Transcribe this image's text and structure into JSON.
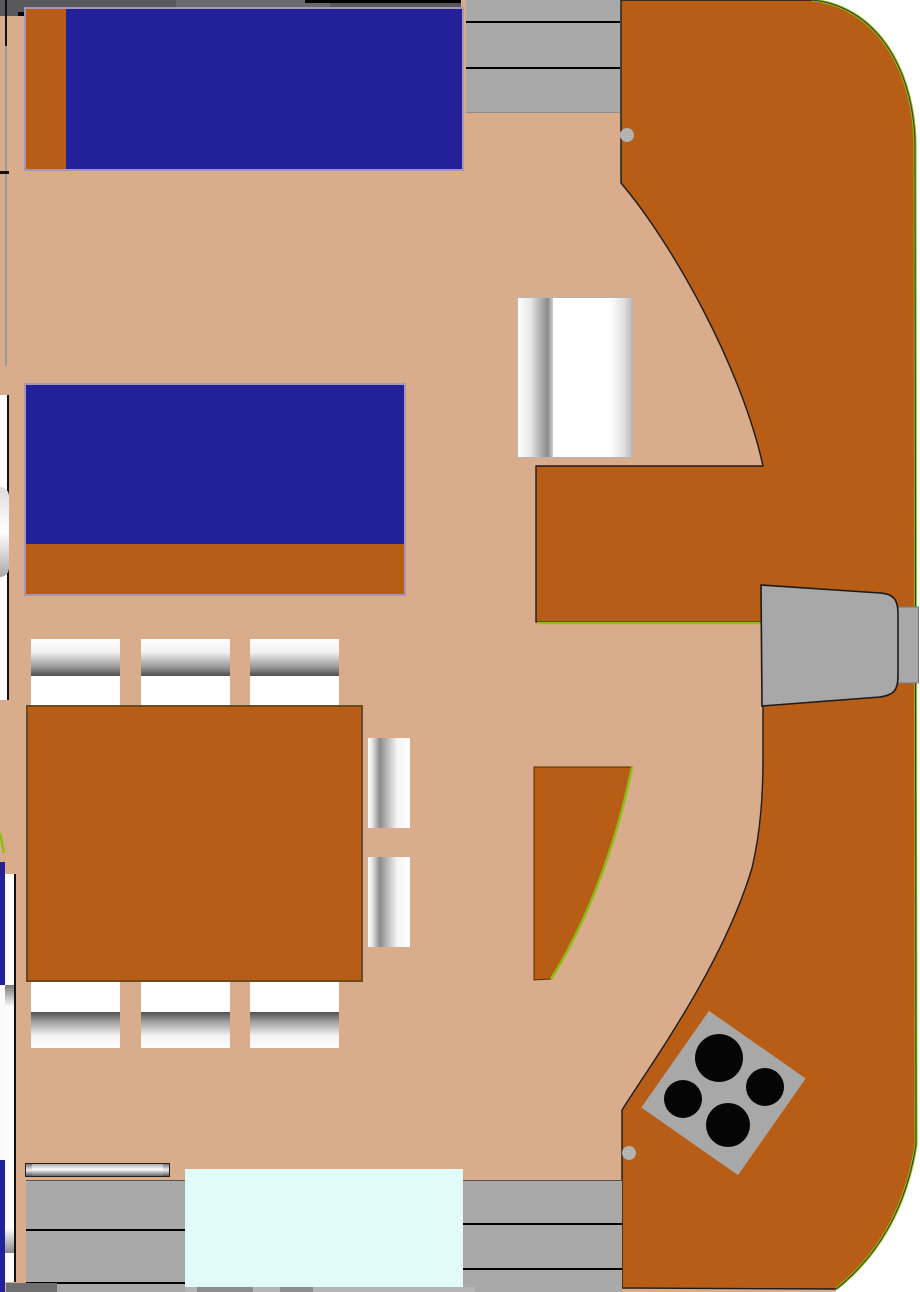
{
  "drawing": {
    "kind": "floor-plan",
    "description": "top-down interior plan with two blue berths, dinette table with eight chairs, curved galley counter, cooktop, steps and helm seat",
    "burner_count": 4,
    "step_treads_top": 3,
    "step_treads_bottom_left": 3,
    "step_treads_bottom_right": 3,
    "chair_count": 8
  },
  "colors": {
    "tan": "#d9ac8b",
    "orange": "#b85d16",
    "blue": "#22219a",
    "band": "#59595b",
    "bandlight": "#6a6a6c",
    "step": "#a9a9a9",
    "seatgray": "#a8a8a8",
    "dotgray": "#b3b3b3",
    "burner": "#050505",
    "hullgreen": "#8ebe12",
    "cyan": "#e0fbfa",
    "bedframe": "#a796b5",
    "white": "#ffffff",
    "outline": "#1a1a1a"
  },
  "paths": {
    "galley": "M621,0 L812,0 C872,6 912,62 915,140 L916,1145 C906,1208 878,1256 836,1289 L622,1288 L622,1110 C648,1068 722,968 752,868 C761,830 763,792 763,755 L763,622 L536,622 L536,466 L763,466 C741,366 672,243 621,183 Z",
    "hull_white": "M812,0 L920,0 L920,1292 L836,1292 L836,1289 C878,1256 906,1208 916,1145 L915,140 C912,62 872,6 812,0 Z",
    "hull_edge": "M812,0 C872,6 912,62 915,140 L916,1145 C906,1208 878,1256 836,1289",
    "counter_edge": "M537,623 L762,623",
    "wedge": "M534,767 L632,767 C614,856 582,930 551,979 L534,980 Z",
    "wedge_edge": "M632,767 C614,856 582,930 551,979",
    "helm_seat": "M761,585 L880,593 C894,594 898,600 898,614 L898,676 C898,690 894,695 880,697 L762,706 Z",
    "port_tick": "M0,833 L4,853"
  },
  "cooktop": {
    "cx": 723.5,
    "cy": 1093,
    "size": 118,
    "angle": 35,
    "burners": [
      {
        "cx": 719,
        "cy": 1058,
        "r": 24
      },
      {
        "cx": 728,
        "cy": 1125,
        "r": 22
      },
      {
        "cx": 683,
        "cy": 1099,
        "r": 19
      },
      {
        "cx": 765,
        "cy": 1087,
        "r": 19
      }
    ]
  },
  "dots": [
    {
      "cx": 627,
      "cy": 135,
      "r": 7
    },
    {
      "cx": 629,
      "cy": 1153,
      "r": 7
    }
  ],
  "wall_ticks": [
    {
      "x": 18,
      "w": 8
    },
    {
      "x": 35,
      "w": 24
    },
    {
      "x": 77,
      "w": 27
    },
    {
      "x": 120,
      "w": 33
    },
    {
      "x": 160,
      "w": 15
    },
    {
      "x": 191,
      "w": 38
    }
  ]
}
